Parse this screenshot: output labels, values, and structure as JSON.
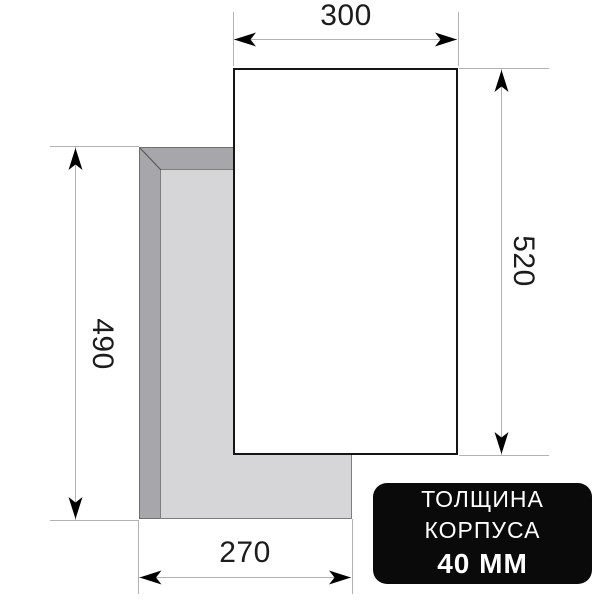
{
  "diagram": {
    "dimensions": {
      "top_width_mm": "300",
      "right_depth_mm": "520",
      "left_cutout_depth_mm": "490",
      "bottom_cutout_width_mm": "270"
    }
  },
  "badge": {
    "line1": "ТОЛЩИНА",
    "line2": "КОРПУСА",
    "line3": "40 ММ"
  },
  "colors": {
    "top_panel_fill": "#ffffff",
    "top_panel_outline": "#151515",
    "body_outer_fill": "#a7a7ab",
    "body_inner_fill": "#d6d6d8",
    "dimension_line": "#b2b2b2",
    "arrowhead": "#000000",
    "badge_background": "#0a0a0a",
    "badge_text": "#ffffff"
  }
}
